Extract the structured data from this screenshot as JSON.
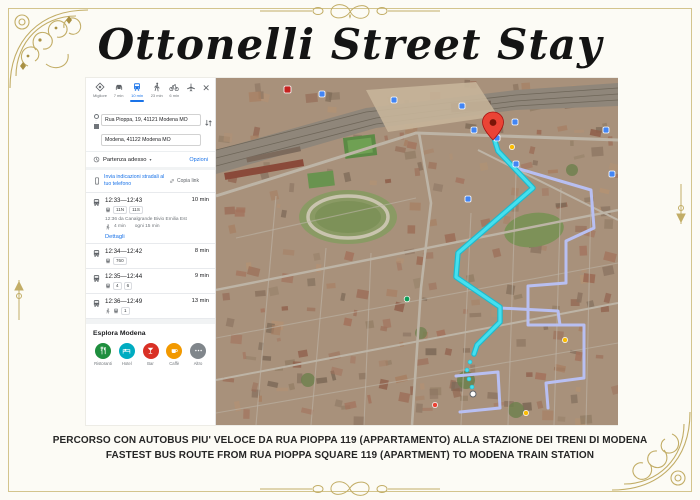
{
  "frame": {
    "title": "Ottonelli Street Stay",
    "ornament_color": "#c2ad66"
  },
  "caption": {
    "line1": "PERCORSO CON AUTOBUS PIU' VELOCE DA RUA PIOPPA 119 (APPARTAMENTO) ALLA STAZIONE DEI TRENI DI MODENA",
    "line2": "FASTEST BUS ROUTE FROM RUA PIOPPA SQUARE 119 (APARTMENT) TO MODENA TRAIN STATION"
  },
  "directions_panel": {
    "modes": [
      {
        "label": "Migliore",
        "icon": "best-route-icon"
      },
      {
        "label": "7 min",
        "icon": "car-icon"
      },
      {
        "label": "10 min",
        "icon": "bus-icon",
        "selected": true
      },
      {
        "label": "23 min",
        "icon": "walk-icon"
      },
      {
        "label": "6 min",
        "icon": "bike-icon"
      },
      {
        "label": "",
        "icon": "plane-icon"
      }
    ],
    "close_label": "✕",
    "origin": "Rua Pioppa, 19, 41121 Modena MO",
    "destination": "Modena, 41122 Modena MO",
    "departure": {
      "label": "Partenza adesso",
      "caret": "▾",
      "options_label": "Opzioni"
    },
    "send": {
      "label": "Invia indicazioni stradali al tuo telefono",
      "copy_label": "Copia link"
    },
    "routes": [
      {
        "time": "12:33—12:43",
        "duration": "10 min",
        "lines": [
          "11N",
          "11S"
        ],
        "departure_info": "12:36 da Canalgrande Bivio Emilia Est",
        "walk_info": "4 min",
        "frequency": "ogni 15 min",
        "details_label": "Dettagli"
      },
      {
        "time": "12:34—12:42",
        "duration": "8 min",
        "lines": [
          "760"
        ]
      },
      {
        "time": "12:35—12:44",
        "duration": "9 min",
        "lines": [
          "4",
          "6"
        ]
      },
      {
        "time": "12:36—12:49",
        "duration": "13 min",
        "lines": [
          "1"
        ]
      }
    ],
    "explore": {
      "title": "Esplora Modena",
      "categories": [
        {
          "label": "Ristoranti",
          "color": "#1e8e3e",
          "icon": "restaurant-icon"
        },
        {
          "label": "Hotel",
          "color": "#00acc1",
          "icon": "hotel-icon"
        },
        {
          "label": "Bar",
          "color": "#d93025",
          "icon": "cocktail-icon"
        },
        {
          "label": "Caffè",
          "color": "#f29900",
          "icon": "coffee-icon"
        },
        {
          "label": "Altro",
          "color": "#80868b",
          "icon": "more-icon"
        }
      ]
    }
  },
  "map": {
    "route_color": "#45e0ef",
    "route_casing": "#1fb9cc",
    "alt_route_color": "#b8bff2",
    "pin_color": "#ea4335",
    "transit_marker_color": "#4285f4"
  }
}
